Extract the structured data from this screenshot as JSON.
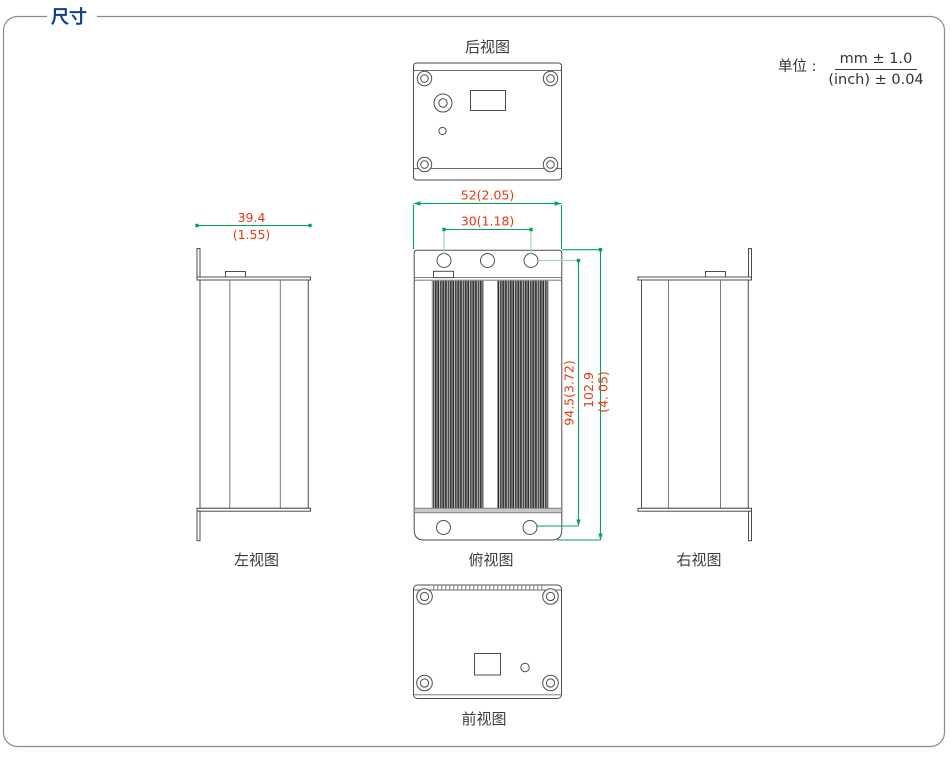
{
  "header": {
    "title": "尺寸"
  },
  "unit": {
    "label": "单位 :",
    "numerator": "mm ± 1.0",
    "denominator": "(inch) ± 0.04"
  },
  "views": {
    "rear": {
      "label": "后视图"
    },
    "left": {
      "label": "左视图"
    },
    "top": {
      "label": "俯视图"
    },
    "right": {
      "label": "右视图"
    },
    "front": {
      "label": "前视图"
    }
  },
  "dimensions": {
    "width_outer": "52(2.05)",
    "width_inner": "30(1.18)",
    "depth_mm": "39.4",
    "depth_inch": "(1.55)",
    "height_holes": "94.5(3.72)",
    "height_total_mm": "102.9",
    "height_total_inch": "(4. 05)"
  },
  "colors": {
    "title_blue": "#0b3f8f",
    "dim_text_red": "#e8380d",
    "dim_line_green": "#00a65d",
    "dim_line_light_green": "#a3d8af",
    "outline_gray": "#4d4d4d"
  }
}
